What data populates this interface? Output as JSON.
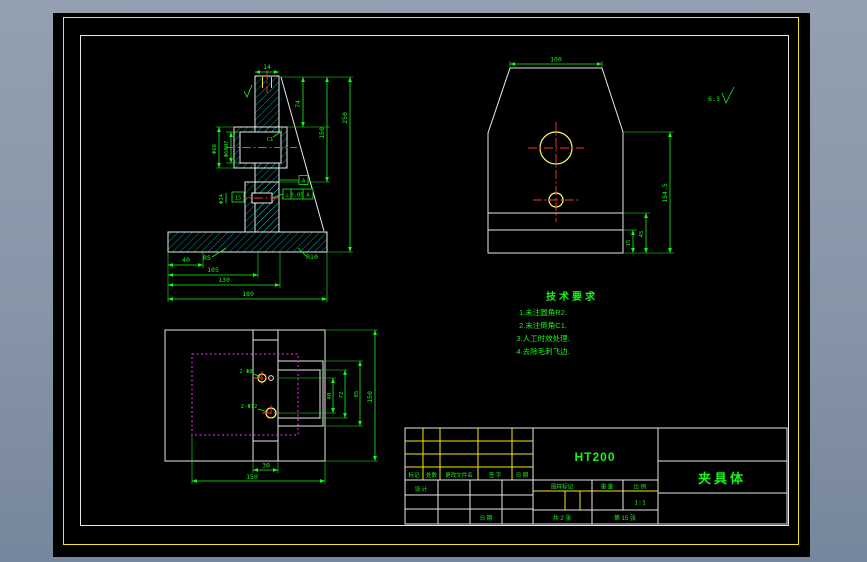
{
  "colors": {
    "outline": "#E8E8E8",
    "dimension": "#16F516",
    "hatch": "#00D8D8",
    "centerline": "#FF3030",
    "hidden_line": "#FF28FF",
    "frame_border": "#F2E80E",
    "circle": "#FFFF60",
    "background": "#8795A8"
  },
  "title_block": {
    "material": "HT200",
    "part_name": "夹具体",
    "header_row": [
      "标记",
      "处数",
      "更改文件名",
      "签 字",
      "日 期"
    ],
    "design_label": "设 计",
    "date_label": "日 期",
    "col_mark": "图样标记",
    "col_weight": "重 量",
    "col_scale": "比 例",
    "scale_value": "1:1",
    "sheet_total": "共 2 张",
    "sheet_no": "第 15 张"
  },
  "tech": {
    "title": "技术要求",
    "items": [
      "1.未注圆角R2.",
      "2.未注倒角C1.",
      "3.人工时效处理.",
      "4.去除毛刺飞边."
    ]
  },
  "front": {
    "dim_top": "14",
    "dim_74": "74",
    "dim_150": "150",
    "dim_250": "250",
    "dim_d68": "Φ68",
    "dim_d60": "Φ60H7",
    "dim_d14": "Φ14",
    "dim_box15": "15",
    "chamfer": "C1",
    "datum_a": "A",
    "fcf_sym": "⊥",
    "fcf_tol": "0.05",
    "fcf_datum": "A",
    "dims_bottom": [
      "40",
      "105",
      "130",
      "180"
    ],
    "fillet_left": "R5",
    "fillet_right": "R10"
  },
  "top": {
    "dim_100": "100",
    "dim_h": "154.5",
    "dim_45": "45",
    "dim_15": "15",
    "roughness": "6.3"
  },
  "bottom": {
    "hole_top": "2-Φ8",
    "hole_bottom": "2-Φ12",
    "dim_40": "40",
    "dim_72": "72",
    "dim_85": "85",
    "dim_150": "150",
    "dim_30": "30",
    "dim_w150": "150"
  }
}
